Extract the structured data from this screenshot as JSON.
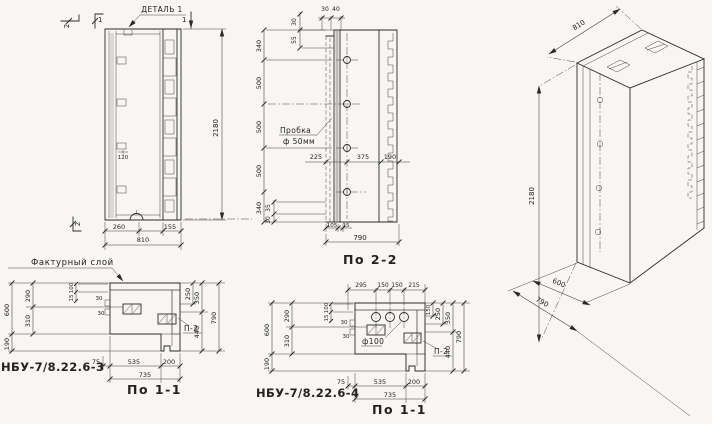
{
  "meta": {
    "drawing_type": "concrete block working drawing",
    "background": "#f7f6f2",
    "ink": "#2b2a27"
  },
  "elevation": {
    "detail_label": "ДЕТАЛЬ 1",
    "marks": {
      "top_a": "2",
      "top_b": "1",
      "top_right": "1",
      "bottom_left": "2"
    },
    "dim_tab": "120",
    "dims_bottom": [
      "260",
      "155",
      "810"
    ],
    "dim_height": "2180"
  },
  "section22": {
    "title": "По 2-2",
    "dims_left": [
      "340",
      "500",
      "500",
      "500",
      "340"
    ],
    "dims_top_h": [
      "30",
      "40"
    ],
    "dims_top_v": [
      "30",
      "55"
    ],
    "plug_label": [
      "Пробка",
      "ф 50мм"
    ],
    "dims_mid": [
      "225",
      "375",
      "190"
    ],
    "dims_bottom_v": [
      "35",
      "30"
    ],
    "dims_bottom_h": [
      "105",
      "15"
    ],
    "dim_width": "790"
  },
  "iso": {
    "dim_width": "810",
    "dim_height": "2180",
    "dim_depth_inner": "600",
    "dim_depth_outer": "790"
  },
  "section11a": {
    "code": "НБУ-7/8.22.6-3",
    "title": "По 1-1",
    "facture_label": "Фактурный слой",
    "p2_label": "П-2",
    "dims_left_outer": [
      "600",
      "190"
    ],
    "dims_left_inner": [
      "290",
      "310"
    ],
    "dims_small": [
      "100",
      "15",
      "30",
      "30"
    ],
    "dims_right": [
      "250",
      "350",
      "440",
      "790"
    ],
    "dims_bottom": [
      "75",
      "535",
      "200",
      "735"
    ]
  },
  "section11b": {
    "code": "НБУ-7/8.22.6-4",
    "title": "По 1-1",
    "hole_label": "ф100",
    "p2_label": "П-2",
    "dims_top": [
      "295",
      "150",
      "150",
      "215"
    ],
    "dims_left_outer": [
      "600",
      "190"
    ],
    "dims_left_inner": [
      "290",
      "310"
    ],
    "dims_small": [
      "100",
      "15",
      "30",
      "30"
    ],
    "dims_right": [
      "150",
      "250",
      "350",
      "440",
      "790"
    ],
    "dims_bottom": [
      "75",
      "535",
      "200",
      "735"
    ]
  }
}
